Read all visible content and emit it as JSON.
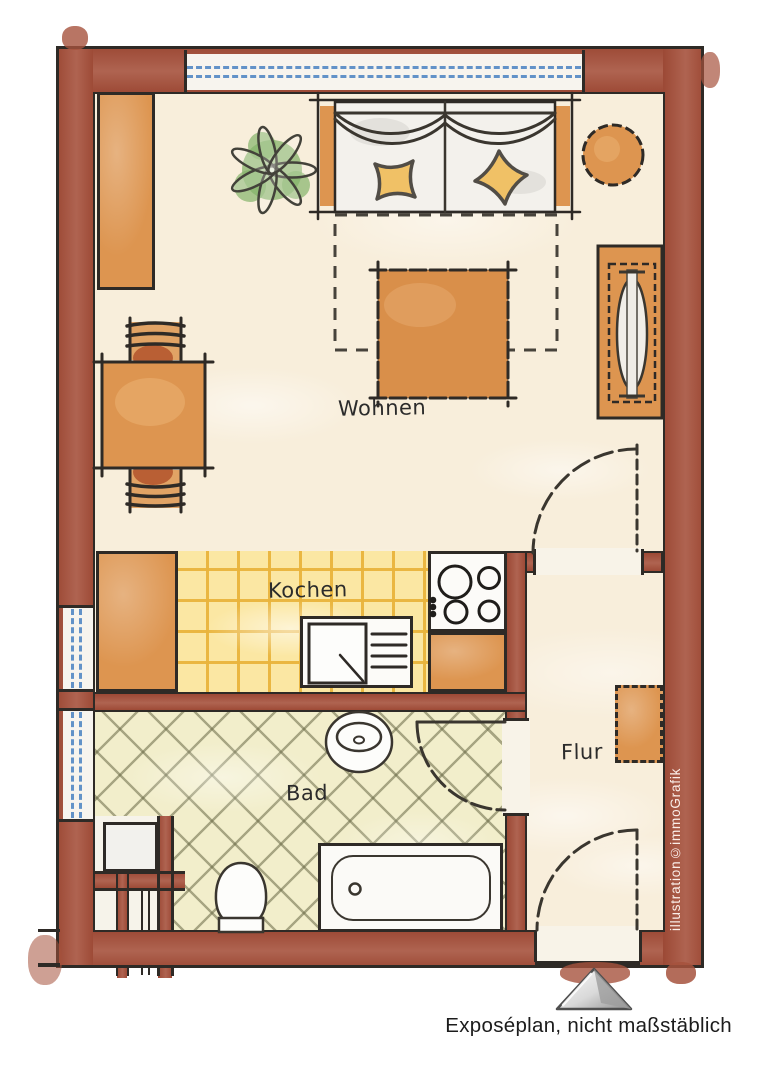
{
  "caption": {
    "text": "Exposéplan, nicht maßstäblich"
  },
  "watermark": {
    "text": "illustration©immoGrafik"
  },
  "rooms": [
    {
      "id": "wohnen",
      "label": "Wohnen"
    },
    {
      "id": "kochen",
      "label": "Kochen"
    },
    {
      "id": "bad",
      "label": "Bad"
    },
    {
      "id": "flur",
      "label": "Flur"
    }
  ],
  "logo": {
    "icon": "metallic-triangle-logo"
  },
  "colors": {
    "wall_brick": "#a6523d",
    "outline_black": "#2e2a26",
    "floor_cream": "#f8eedb",
    "kitchen_tile": "#fbe7a3",
    "kitchen_grid": "#eebd45",
    "bath_tile": "#f2eecb",
    "furniture_orange": "#dd9550",
    "pillow_yellow": "#f0c166",
    "plant_green": "#85b36b",
    "window_blue": "#6292c8",
    "logo_gray": "#9a9a9a"
  }
}
